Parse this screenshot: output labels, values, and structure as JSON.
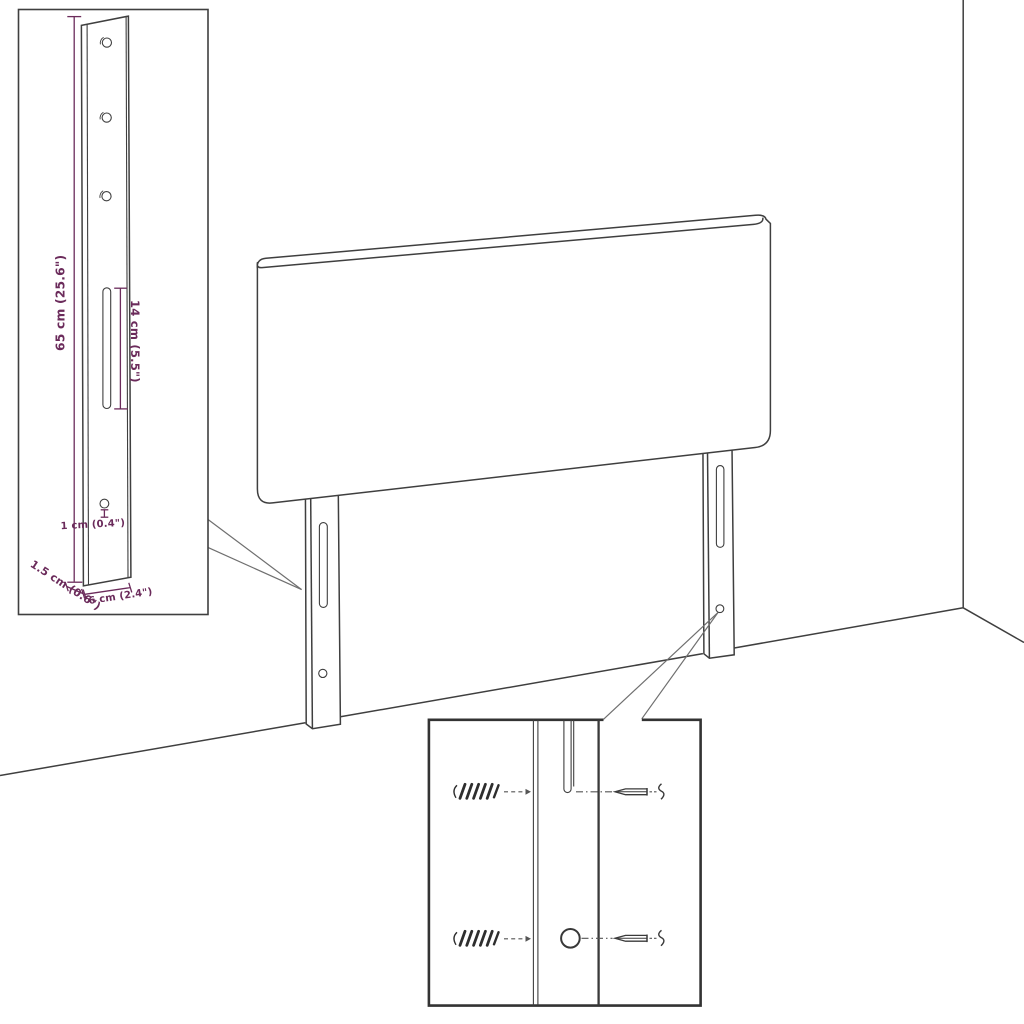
{
  "diagram": {
    "type": "furniture-headboard-mounting-dimension-diagram",
    "line_color": "#3f3f3f",
    "dimension_color": "#6b2b5b",
    "labels": {
      "bracket_height": "65 cm (25.6\")",
      "slot_length": "14 cm (5.5\")",
      "hole_diameter": "1 cm (0.4\")",
      "bracket_depth": "1.5 cm (0.6\")",
      "bracket_width": "6 cm (2.4\")"
    }
  }
}
